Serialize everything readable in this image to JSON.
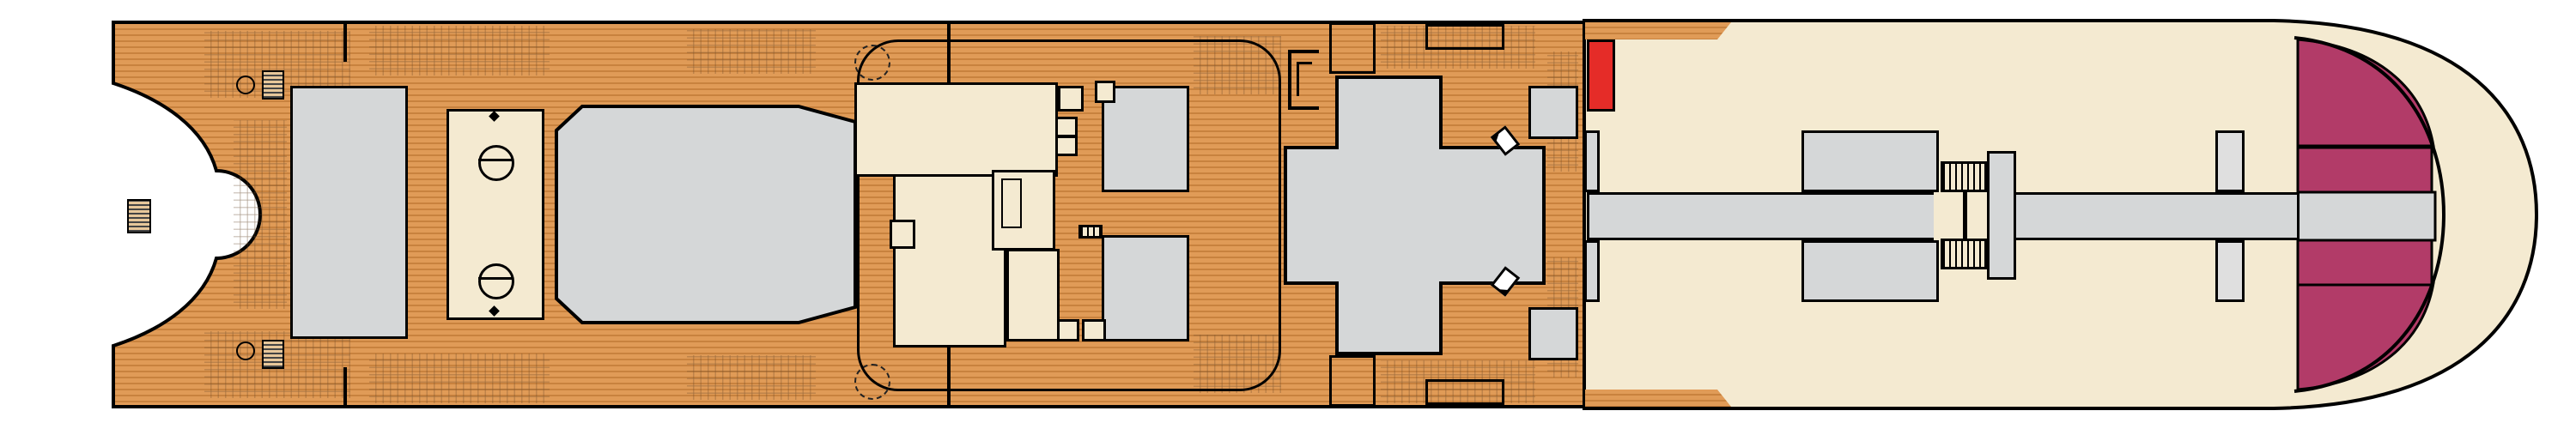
{
  "title": "Deck 11 plan",
  "labels": {
    "sports_court": "SPORTS COURT",
    "camp_ocean": "CAMP OCEAN",
    "dr_seuss_line1": "DR. SEUSS",
    "dr_seuss_line2": "BOOKVILLE",
    "pergola_line1": "PERGOLA",
    "pergola_line2": "BAR",
    "theatre_line1": "CARNIVAL SEASIDE",
    "theatre_line2": "THEATRE",
    "el": "EL",
    "u": "U",
    "m": "M",
    "l": "L"
  },
  "colors": {
    "wood": "#e09b57",
    "wood_line": "#c8823e",
    "cream": "#f4ead1",
    "gray": "#d5d7d8",
    "red_cabin": "#e52c28",
    "mauve_cabin": "#b17289",
    "green_cabin": "#a7dabd",
    "teal_cabin": "#0fa8b6",
    "magenta_cabin": "#b23b68",
    "elevator_pink": "#f6a6cf"
  },
  "cabins": {
    "top": [
      {
        "n": "11288",
        "c": "red"
      },
      {
        "n": "11284",
        "c": "red",
        "sym": "★",
        "dia": true
      },
      {
        "n": "11280",
        "c": "red"
      },
      {
        "n": "11276",
        "c": "red"
      },
      {
        "n": "11272",
        "c": "red",
        "sym": "★"
      },
      {
        "n": "11268",
        "c": "red"
      },
      {
        "n": "11266",
        "c": "red",
        "sym": "★"
      },
      {
        "n": "11260",
        "c": "red",
        "dia": true
      },
      {
        "n": "11258",
        "c": "red"
      },
      {
        "n": "11256",
        "c": "red",
        "sym": "★"
      },
      {
        "n": "11254",
        "c": "red",
        "sym": "="
      },
      {
        "n": "11252",
        "c": "red",
        "sym": "★",
        "dia": true
      },
      {
        "n": "11250",
        "c": "mauve"
      },
      {
        "n": "11248",
        "c": "mauve",
        "sym": "■"
      },
      {
        "n": "11246",
        "c": "mauve"
      },
      {
        "n": "11242",
        "c": "mauve"
      },
      {
        "n": "11238",
        "c": "mauve"
      },
      {
        "n": "11234",
        "c": "mauve",
        "sym": "★"
      },
      {
        "n": "11230",
        "c": "mauve"
      },
      {
        "n": "11226",
        "c": "mauve"
      },
      {
        "n": "11222",
        "c": "mauve"
      },
      {
        "n": "11218",
        "c": "mauve"
      },
      {
        "n": "11214",
        "c": "mauve"
      },
      {
        "n": "11210",
        "c": "mauve"
      },
      {
        "n": "11206",
        "c": "teal",
        "sym": "★"
      }
    ],
    "bottom": [
      {
        "n": "11287",
        "c": "red"
      },
      {
        "n": "11283",
        "c": "red",
        "sym": "★",
        "dia": true
      },
      {
        "n": "11279",
        "c": "red"
      },
      {
        "n": "11275",
        "c": "red"
      },
      {
        "n": "11271",
        "c": "red",
        "sym": "★"
      },
      {
        "n": "11267",
        "c": "red",
        "dia": true
      },
      {
        "n": "11263",
        "c": "red",
        "sym": "★"
      },
      {
        "n": "11259",
        "c": "red"
      },
      {
        "n": "11257",
        "c": "red",
        "sym": "★"
      },
      {
        "n": "11255",
        "c": "red",
        "sym": "★"
      },
      {
        "n": "11253",
        "c": "red",
        "sym": "="
      },
      {
        "n": "11251",
        "c": "red",
        "sym": "★",
        "dia": true
      },
      {
        "n": "11249",
        "c": "mauve"
      },
      {
        "n": "11247",
        "c": "mauve",
        "sym": "■"
      },
      {
        "n": "11245",
        "c": "mauve"
      },
      {
        "n": "11241",
        "c": "mauve",
        "sym": "★"
      },
      {
        "n": "11237",
        "c": "mauve"
      },
      {
        "n": "11233",
        "c": "mauve",
        "sym": "★"
      },
      {
        "n": "11229",
        "c": "mauve"
      },
      {
        "n": "11225",
        "c": "mauve"
      },
      {
        "n": "11221",
        "c": "mauve"
      },
      {
        "n": "11217",
        "c": "teal"
      },
      {
        "n": "11211",
        "c": "teal",
        "sym": "+"
      },
      {
        "n": "11205",
        "c": "teal"
      }
    ],
    "mid_upper_1": [
      {
        "n": "11286",
        "c": "green"
      },
      {
        "n": "11282",
        "c": "green"
      },
      {
        "n": "11278",
        "c": "green"
      },
      {
        "n": "11274",
        "c": "green"
      }
    ],
    "mid_upper_2": [
      {
        "n": "11270",
        "c": "green"
      },
      {
        "n": "11264",
        "c": "green"
      },
      {
        "n": "11262",
        "c": "green"
      }
    ],
    "mid_upper_3": [
      {
        "n": "11244",
        "c": "green"
      },
      {
        "n": "11240",
        "c": "green",
        "sym": ":"
      },
      {
        "n": "11236",
        "c": "green"
      },
      {
        "n": "11232",
        "c": "green"
      },
      {
        "n": "11228",
        "c": "green"
      },
      {
        "n": "11224",
        "c": "green"
      },
      {
        "n": "11220",
        "c": "green"
      }
    ],
    "mid_upper_4": [
      {
        "n": "11212",
        "c": "green"
      },
      {
        "n": "11208",
        "c": "green",
        "sym": "★"
      }
    ],
    "mid_lower_1": [
      {
        "n": "11285",
        "c": "green"
      },
      {
        "n": "11281",
        "c": "green"
      },
      {
        "n": "11277",
        "c": "green"
      },
      {
        "n": "11273",
        "c": "green"
      }
    ],
    "mid_lower_2": [
      {
        "n": "11269",
        "c": "green"
      },
      {
        "n": "11265",
        "c": "green"
      },
      {
        "n": "11261",
        "c": "green"
      }
    ],
    "mid_lower_3": [
      {
        "n": "11243",
        "c": "green"
      },
      {
        "n": "11239",
        "c": "green",
        "sym": "·"
      },
      {
        "n": "11235",
        "c": "green"
      },
      {
        "n": "11231",
        "c": "green"
      },
      {
        "n": "11227",
        "c": "green"
      },
      {
        "n": "11223",
        "c": "green"
      },
      {
        "n": "11219",
        "c": "green"
      }
    ],
    "mid_lower_4": [
      {
        "n": "11209",
        "c": "green",
        "sym": "■"
      },
      {
        "n": "11207",
        "c": "green",
        "sym": "★"
      }
    ],
    "bow": {
      "f204": "11204",
      "f202": "11202",
      "f201": "11201",
      "f203": "11203"
    }
  }
}
